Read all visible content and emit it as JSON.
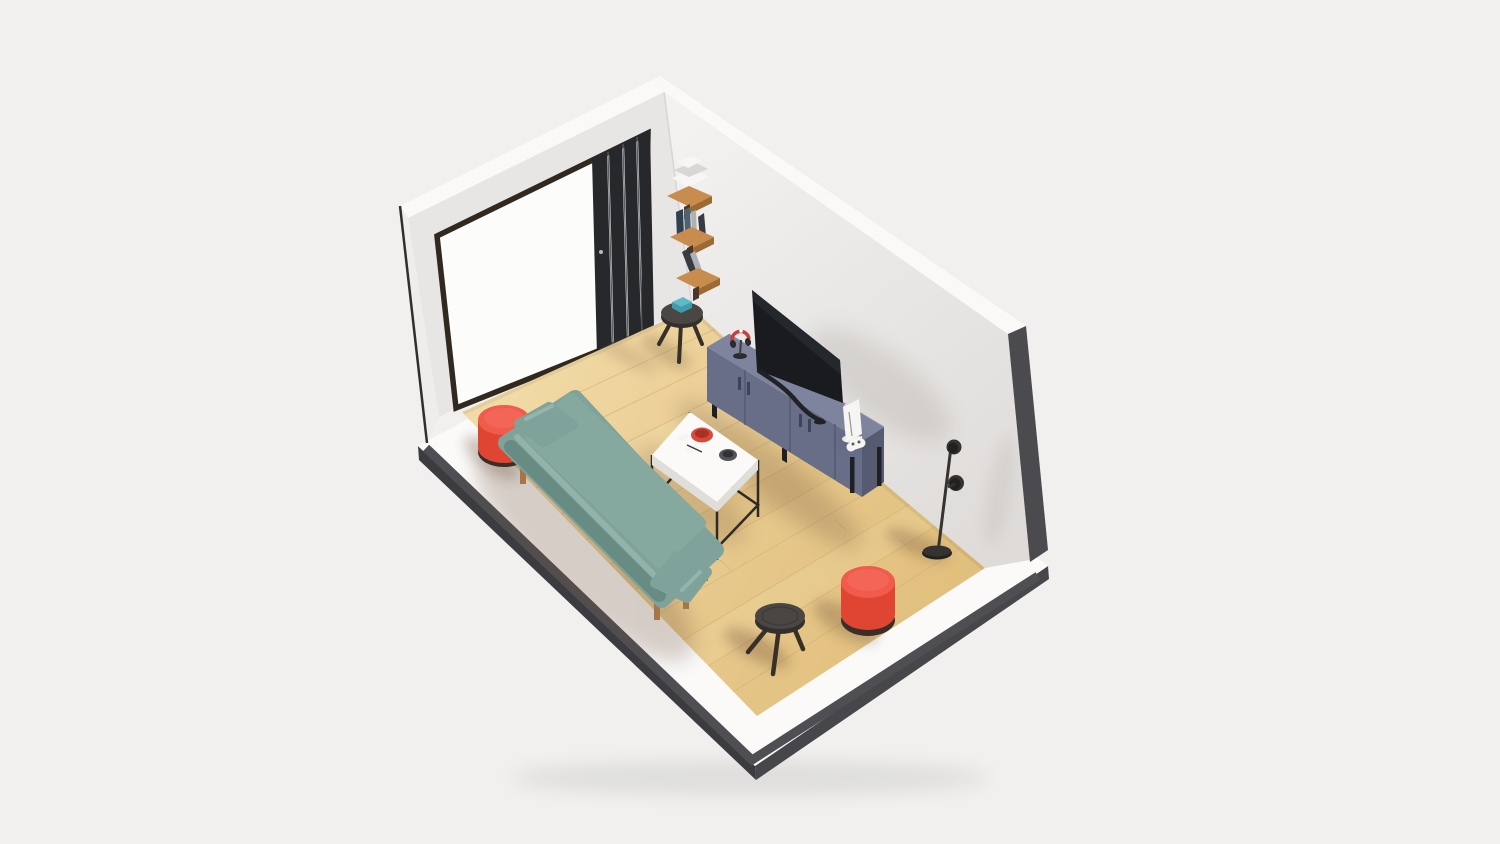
{
  "scene": {
    "type": "isometric-3d-room-render",
    "description": "Miniature cutaway living room diorama on a plinth: wood plank floor, two white walls, black folding glass door, wall shelves with books, teal two-seat sofa, red cylindrical poufs, white coffee table with red bowl, slate-blue TV sideboard with television, white game console and controller, headphones, round side tables, and a two-headed black floor lamp.",
    "objects": [
      {
        "name": "room-plinth",
        "color_key": "plinth"
      },
      {
        "name": "wood-floor",
        "color_key": "floorB"
      },
      {
        "name": "left-wall-with-door",
        "color_key": "wallLeft"
      },
      {
        "name": "right-wall",
        "color_key": "wallRightA"
      },
      {
        "name": "folding-door-panels",
        "color_key": "doorPanel"
      },
      {
        "name": "wall-shelves-with-books",
        "color_key": "shelfWood"
      },
      {
        "name": "side-table-with-teal-books",
        "color_key": "stoolTop"
      },
      {
        "name": "teal-sofa",
        "color_key": "sofaMain"
      },
      {
        "name": "coffee-table",
        "color_key": "tableTop"
      },
      {
        "name": "red-bowl",
        "color_key": "bowlRed"
      },
      {
        "name": "tv-sideboard",
        "color_key": "consoleFront"
      },
      {
        "name": "television",
        "color_key": "tvScreen"
      },
      {
        "name": "game-console-and-controller",
        "color_key": "deviceWhite"
      },
      {
        "name": "headphones",
        "color_key": "headphoneRed"
      },
      {
        "name": "red-pouf-left",
        "color_key": "pouf"
      },
      {
        "name": "red-pouf-right",
        "color_key": "pouf"
      },
      {
        "name": "black-stool",
        "color_key": "stoolTop"
      },
      {
        "name": "floor-lamp",
        "color_key": "lampMid"
      }
    ]
  },
  "palette": {
    "bg": "#F1F0EE",
    "wallTop": "#FAF9F7",
    "wallLeft": "#E8E6E4",
    "wallLeftEdge": "#EFEDEB",
    "wallRightA": "#F3F2F0",
    "wallRightB": "#DEDBD9",
    "wallCutDark": "#4A4A4F",
    "edgeLine": "#332E29",
    "plinth": "#FBFAF9",
    "plinthStripe": "#4E4E53",
    "plinthSideSW": "#3C3C40",
    "plinthSideSE": "#46464B",
    "floorA": "#F1DAA6",
    "floorB": "#E9CB90",
    "floorC": "#E1BF7D",
    "plank": "#D2B076",
    "doorOpen": "#FCFCFB",
    "doorFrame": "#31291F",
    "doorPanel": "#26282B",
    "doorPanelHi": "#5A5D61",
    "shelfWood": "#C98C4F",
    "shelfWoodDark": "#9C6A33",
    "bracket": "#4A372A",
    "bookWhite": "#F7F6F4",
    "bookGray": "#D8D7D5",
    "bookNavy": "#31404F",
    "bookSlate": "#50616F",
    "bookLight": "#AEB1B5",
    "bookDark": "#383B41",
    "tealBook": "#5FB9C6",
    "tealBookDark": "#3F9DAB",
    "sofaMain": "#7FA39A",
    "sofaCushion": "#85A89F",
    "sofaLight": "#93B5AB",
    "sofaDark": "#688B83",
    "sofaLeg": "#A5764A",
    "pouf": "#F15B4B",
    "poufDark": "#E04534",
    "poufBase": "#3A2E29",
    "tableTop": "#FBFAF8",
    "tableSide": "#E0DEDA",
    "tableFrame": "#2E2A26",
    "bowlRed": "#D8493B",
    "bowlRedDark": "#A93225",
    "discGray": "#53555B",
    "discGrayDark": "#303237",
    "consoleTop": "#7E849D",
    "consoleFront": "#686E87",
    "consoleEnd": "#565B72",
    "consoleSeam": "#4F5570",
    "consoleLeg": "#1F2023",
    "tvScreen": "#1A1B1E",
    "tvHi": "#2A2C31",
    "tvStand": "#212226",
    "deviceWhite": "#F6F5F3",
    "detailDark": "#2A2B2E",
    "headphoneRed": "#C8403A",
    "stoolTop": "#4A4643",
    "stoolDark": "#332F2C",
    "legDark": "#382F28",
    "lampMid": "#35322F",
    "lampDark": "#23211F",
    "shadowWarm": "#6B4E38",
    "shadowCool": "#8F8880"
  }
}
